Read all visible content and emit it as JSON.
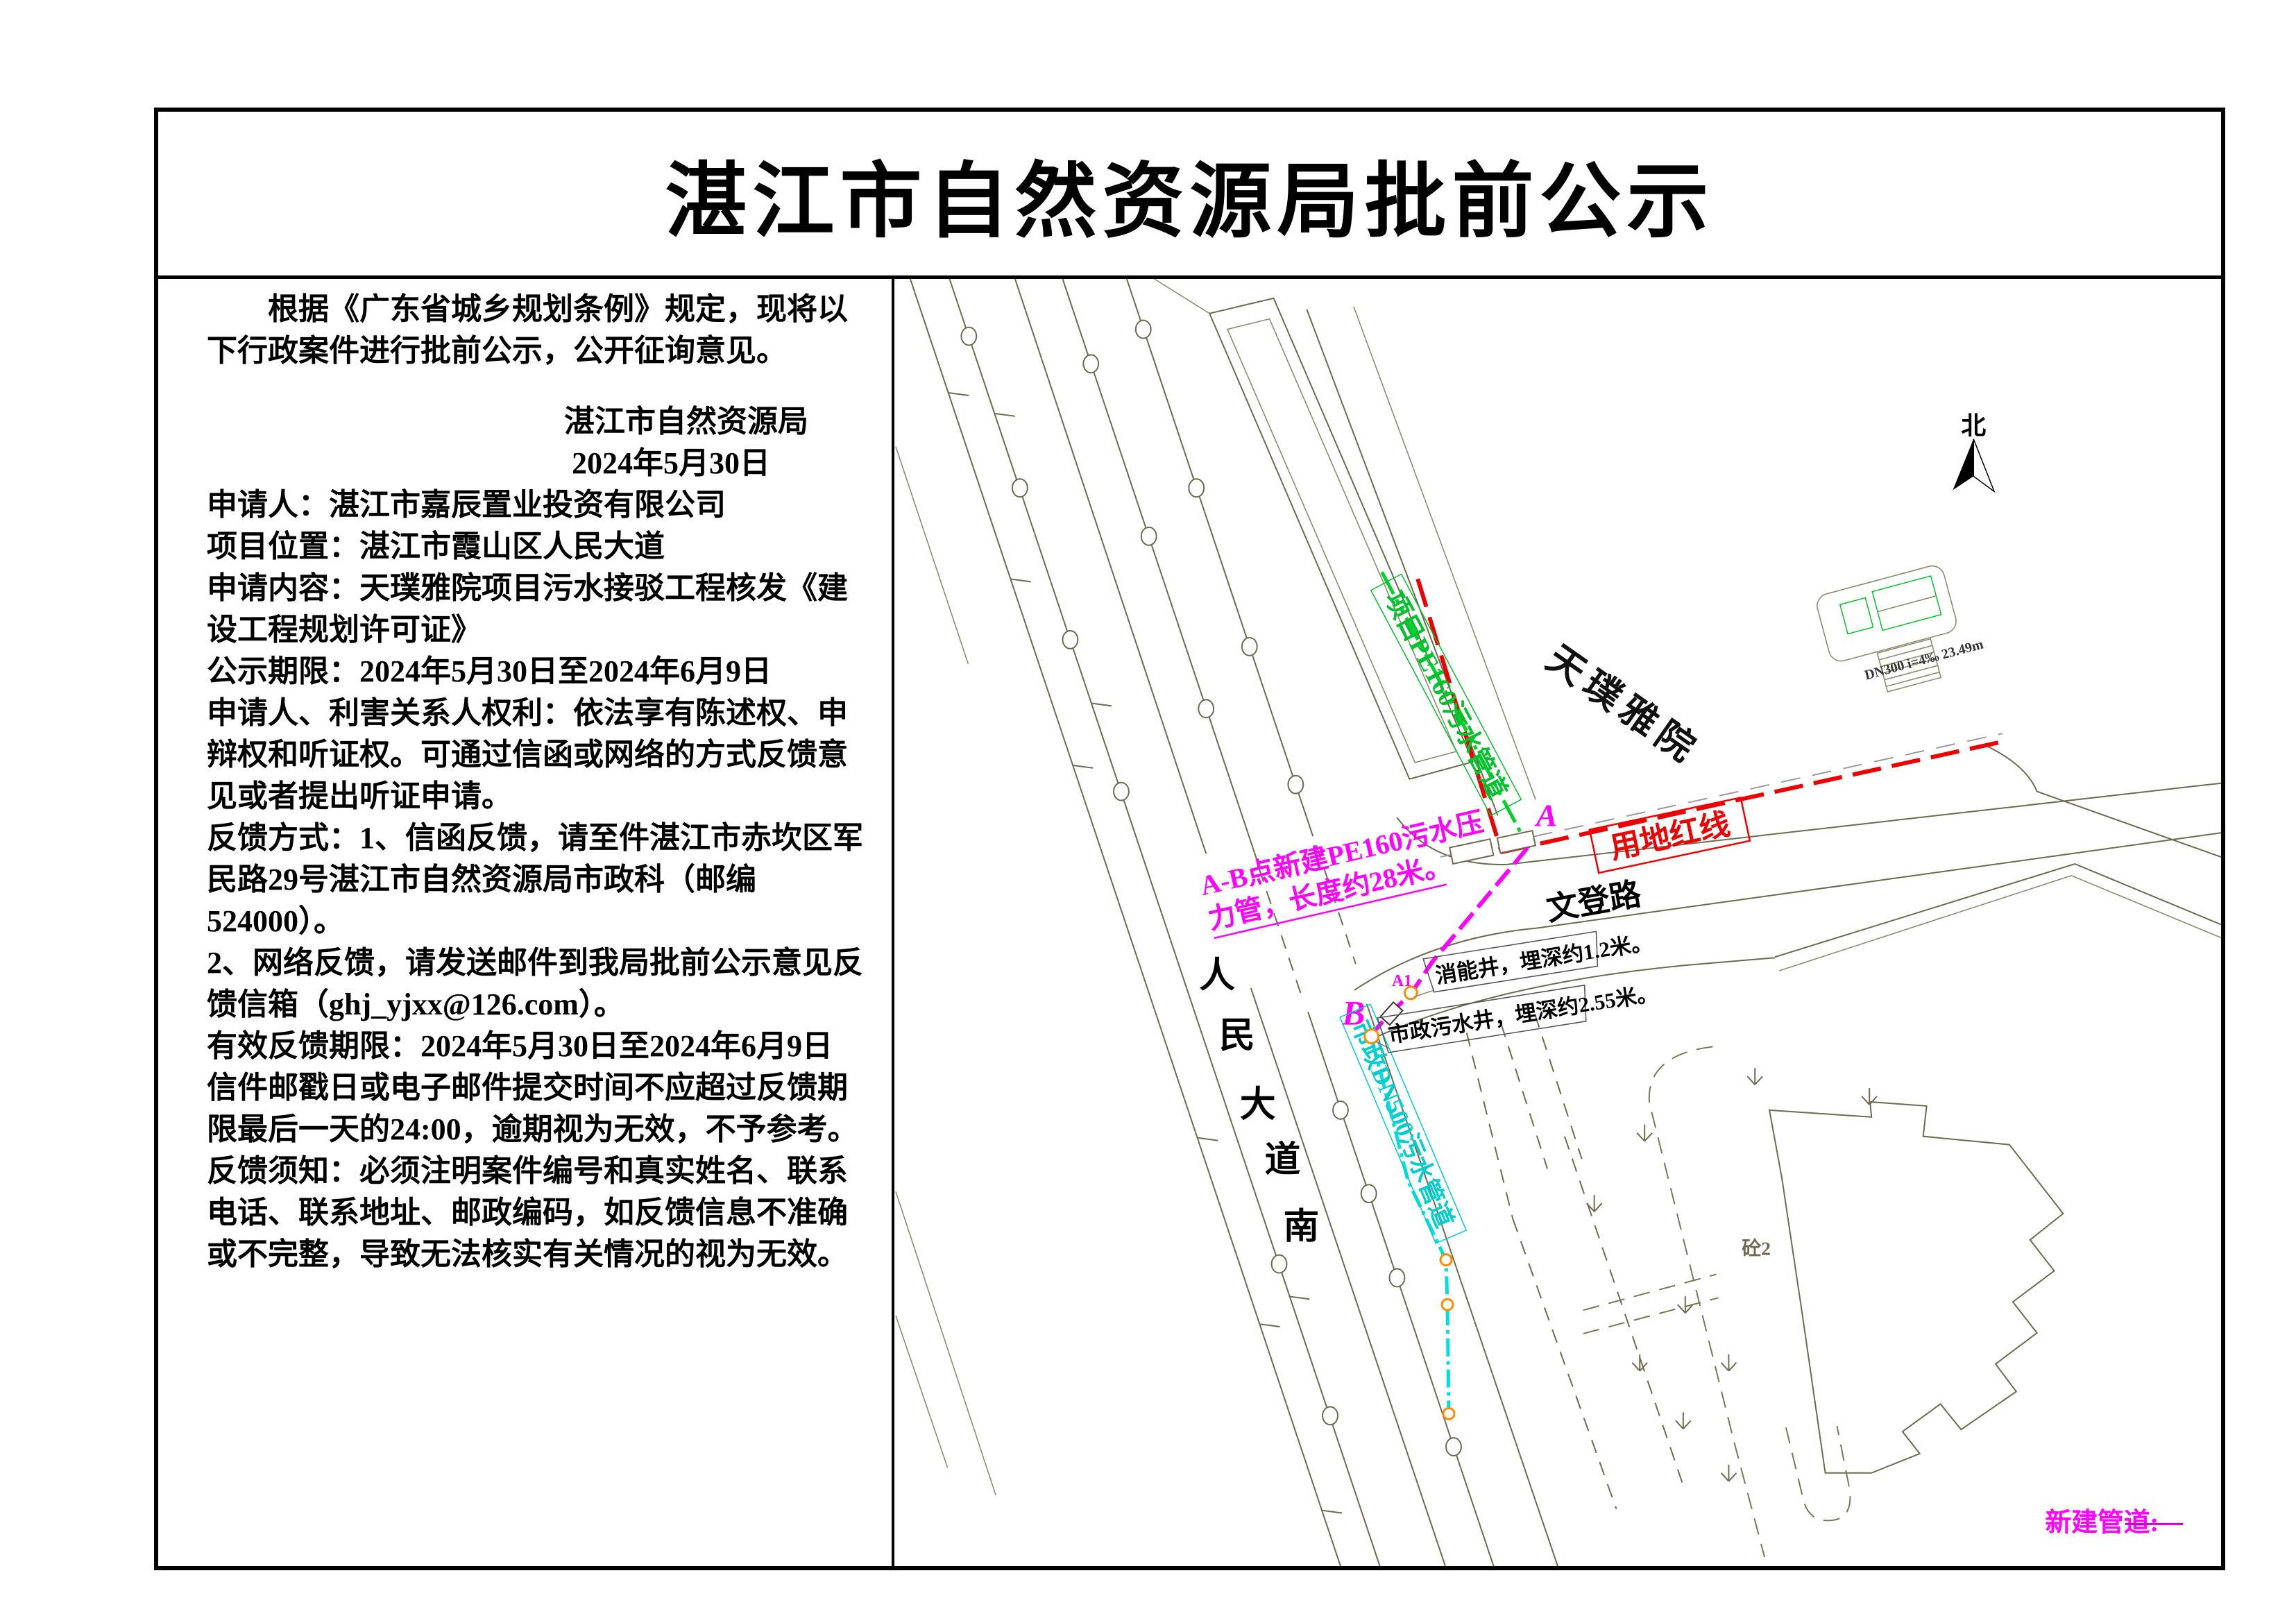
{
  "title": "湛江市自然资源局批前公示",
  "notice": {
    "p1": "根据《广东省城乡规划条例》规定，现将以下行政案件进行批前公示，公开征询意见。",
    "signature_org": "湛江市自然资源局",
    "signature_date": "2024年5月30日",
    "applicant": "申请人：湛江市嘉辰置业投资有限公司",
    "location": "项目位置：湛江市霞山区人民大道",
    "content": "申请内容：天璞雅院项目污水接驳工程核发《建设工程规划许可证》",
    "period": "公示期限：2024年5月30日至2024年6月9日",
    "rights": "申请人、利害关系人权利：依法享有陈述权、申辩权和听证权。可通过信函或网络的方式反馈意见或者提出听证申请。",
    "feedback_mail": "反馈方式：1、信函反馈，请至件湛江市赤坎区军民路29号湛江市自然资源局市政科（邮编524000）。",
    "feedback_online": "2、网络反馈，请发送邮件到我局批前公示意见反馈信箱（ghj_yjxx@126.com）。",
    "feedback_valid": "有效反馈期限：2024年5月30日至2024年6月9日",
    "feedback_deadline": "信件邮戳日或电子邮件提交时间不应超过反馈期限最后一天的24:00，逾期视为无效，不予参考。",
    "feedback_note": "反馈须知：必须注明案件编号和真实姓名、联系电话、联系地址、邮政编码，如反馈信息不准确或不完整，导致无法核实有关情况的视为无效。"
  },
  "map": {
    "north_label": "北",
    "project_name": "天璞雅院",
    "road_renmin_chars": [
      "人",
      "民",
      "大",
      "道",
      "南"
    ],
    "road_wendeng": "文登路",
    "red_line_label": "用地红线",
    "green_pipe_label": "项目PE160污水管道",
    "ab_pipe_label_line1": "A-B点新建PE160污水压",
    "ab_pipe_label_line2": "力管，长度约28米。",
    "cyan_pipe_label": "市政DN500污水管道",
    "point_a": "A",
    "point_a1": "A1",
    "point_b": "B",
    "well_energy": "消能井，埋深约1.2米。",
    "well_municipal": "市政污水井，埋深约2.55米。",
    "building_label": "砼2",
    "detail_label": "DN300 i=4‰ 23.49m",
    "legend_new_pipe": "新建管道:"
  },
  "colors": {
    "red_line": "#ee0000",
    "green_pipe": "#00d22a",
    "new_pipe_magenta": "#ff00ff",
    "municipal_pipe_cyan": "#00dede",
    "map_line_olive": "#6e6a50",
    "node_orange": "#ff8c00"
  }
}
